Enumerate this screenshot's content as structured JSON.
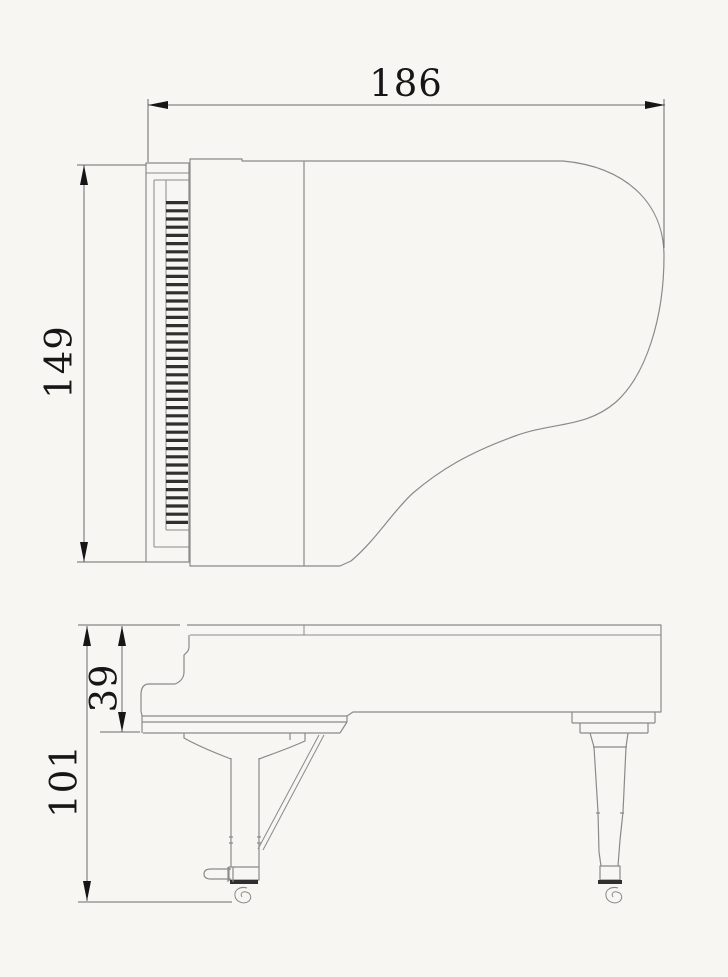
{
  "page": {
    "background": "#f7f6f3"
  },
  "drawing": {
    "type": "technical-dimension-drawing",
    "subject": "grand piano, top view and side view",
    "dimensions": {
      "width": "186",
      "depth": "149",
      "rim_height": "39",
      "total_height": "101"
    },
    "colors": {
      "background": "#f7f6f3",
      "line": "#8a8a8a",
      "dark": "#2f2f2f",
      "dimension": "#6b6b6b",
      "text": "#161616"
    }
  }
}
